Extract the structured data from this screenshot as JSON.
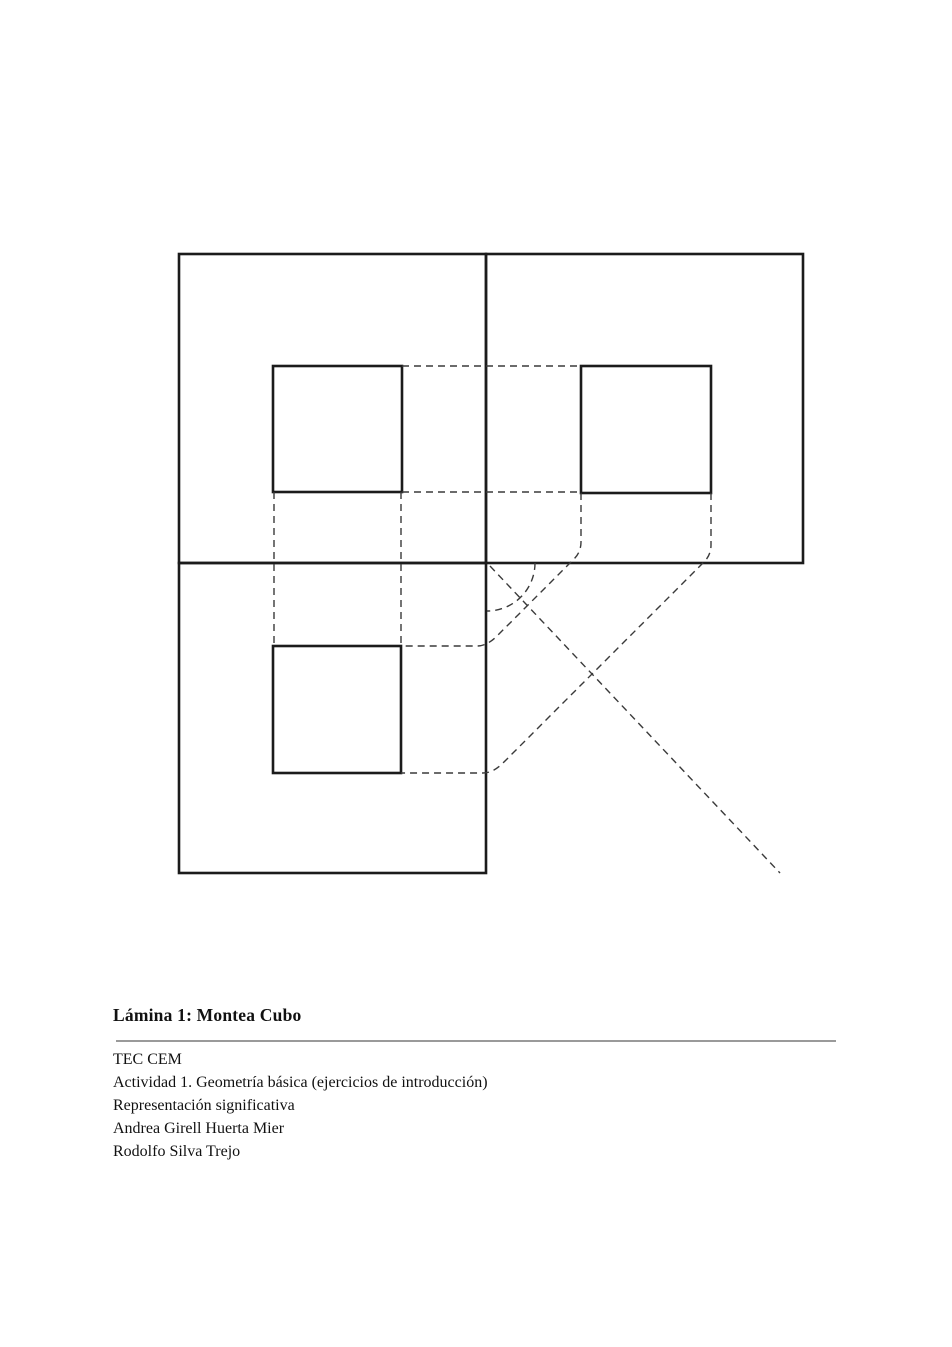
{
  "caption": {
    "title": "Lámina 1: Montea Cubo",
    "lines": [
      "TEC CEM",
      "Actividad 1. Geometría básica (ejercicios de introducción)",
      "Representación significativa",
      "Andrea Girell Huerta Mier",
      "Rodolfo Silva Trejo"
    ]
  },
  "colors": {
    "solid_line": "#1b1b1b",
    "dashed_line": "#3a3a3a",
    "rule": "#9a9a9a",
    "background": "#ffffff"
  },
  "drawing": {
    "solid_stroke_width": 2.6,
    "dashed_stroke_width": 1.4,
    "dash_pattern": "7 5",
    "solid_rects": [
      {
        "name": "outer-rect-top-left-view",
        "x": 179,
        "y": 254,
        "w": 307,
        "h": 309
      },
      {
        "name": "outer-rect-top-right-view",
        "x": 486,
        "y": 254,
        "w": 317,
        "h": 309
      },
      {
        "name": "outer-rect-bottom-left-view",
        "x": 179,
        "y": 563,
        "w": 307,
        "h": 310
      },
      {
        "name": "inner-square-top-left-view",
        "x": 273,
        "y": 366,
        "w": 129,
        "h": 126
      },
      {
        "name": "inner-square-top-right-view",
        "x": 581,
        "y": 366,
        "w": 130,
        "h": 127
      },
      {
        "name": "inner-square-bottom-left-view",
        "x": 273,
        "y": 646,
        "w": 128,
        "h": 127
      }
    ],
    "dashed_paths": [
      {
        "name": "projection-line-top-edges",
        "d": "M402,366 L581,366"
      },
      {
        "name": "projection-line-bottom-edges",
        "d": "M402,492 L581,492"
      },
      {
        "name": "projection-line-left-edges",
        "d": "M274,492 L274,646"
      },
      {
        "name": "projection-line-right-edges",
        "d": "M401,492 L401,646"
      },
      {
        "name": "transfer-path-near-edge",
        "d": "M581,493 L581,542 Q581,552 574,559 L497,636 Q487,646 477,646 L402,646"
      },
      {
        "name": "transfer-path-far-edge",
        "d": "M711,493 L711,545 Q711,555 704,562 L503,763 Q493,773 483,773 L401,773"
      },
      {
        "name": "miter-diagonal-line",
        "d": "M490,566 L780,873"
      },
      {
        "name": "transfer-arc",
        "d": "M535,563 A48,48 0 0 1 487,611"
      }
    ]
  }
}
